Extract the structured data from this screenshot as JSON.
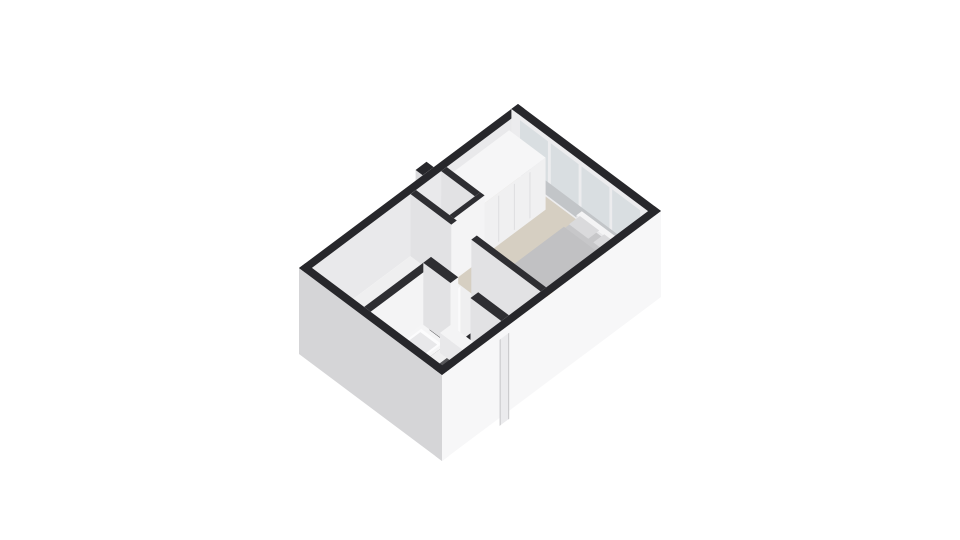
{
  "canvas": {
    "width": 960,
    "height": 540,
    "background": "#ffffff"
  },
  "scene": {
    "description": "3D isometric floor plan render of an upper floor with bedroom, hallway, staircase and bathroom",
    "rooms": [
      "bedroom",
      "closet-nook",
      "hallway",
      "staircase",
      "bathroom",
      "open-room"
    ],
    "palette": {
      "wall_top_exterior": "#27272b",
      "wall_top_interior": "#2e2e32",
      "facade_sw": "#d5d5d7",
      "facade_se": "#f7f7f8",
      "facade_seam": "#c9c9cb",
      "inner_wall_light": "#f4f4f5",
      "inner_wall_shade": "#e2e2e4",
      "floor_hall": "#efeff0",
      "floor_carpet": "#d6cfc2",
      "floor_bathroom": "#57575a",
      "glass": "#d9dee1",
      "stair_tread": "#2b2b2f",
      "lamp_amber": "#d9993e"
    }
  },
  "projection": {
    "origin": [
      299,
      268
    ],
    "axis_x": [
      219,
      -164
    ],
    "axis_y": [
      143,
      107
    ],
    "wall_top_z": 62
  },
  "elements": [
    {
      "name": "exterior-duct-bump",
      "type": "box",
      "rect": [
        0.565,
        -0.05,
        0.615,
        0.0
      ],
      "z0": 0,
      "z1": 62,
      "top": "#27272b",
      "sw": "#dcdcde",
      "se": "#e9e9eb"
    },
    {
      "name": "wall-northwest-exterior",
      "type": "box",
      "rect": [
        0,
        0,
        1,
        0.045
      ],
      "z0": 0,
      "z1": 62,
      "top": "#27272b",
      "sw": "#d6d6d8",
      "se": "#e9e9eb"
    },
    {
      "name": "wall-northeast-exterior",
      "type": "box",
      "rect": [
        0.97,
        0,
        1,
        1
      ],
      "z0": 0,
      "z1": 62,
      "top": "#27272b",
      "sw": "#ececee",
      "se": "#f7f7f8"
    },
    {
      "name": "window-pane-1",
      "type": "face",
      "plane": "x",
      "at": 0.97,
      "range": [
        0.06,
        0.255
      ],
      "z": [
        5,
        57
      ],
      "fill": "#d9dee1"
    },
    {
      "name": "window-pane-2",
      "type": "face",
      "plane": "x",
      "at": 0.97,
      "range": [
        0.275,
        0.47
      ],
      "z": [
        5,
        57
      ],
      "fill": "#d9dee1"
    },
    {
      "name": "window-pane-3",
      "type": "face",
      "plane": "x",
      "at": 0.97,
      "range": [
        0.49,
        0.685
      ],
      "z": [
        5,
        57
      ],
      "fill": "#d9dee1"
    },
    {
      "name": "window-pane-4",
      "type": "face",
      "plane": "x",
      "at": 0.97,
      "range": [
        0.705,
        0.9
      ],
      "z": [
        5,
        57
      ],
      "fill": "#d9dee1"
    },
    {
      "name": "window-sill-band",
      "type": "face",
      "plane": "x",
      "at": 0.97,
      "range": [
        0.06,
        0.9
      ],
      "z": [
        2,
        16
      ],
      "fill": "#c2c5c8"
    },
    {
      "name": "floor-hallway-base",
      "type": "floor",
      "rect": [
        0.03,
        0.045,
        0.97,
        0.955
      ],
      "z": 0,
      "fill": "#efeff0"
    },
    {
      "name": "floor-bedroom-carpet",
      "type": "floor",
      "rect": [
        0.505,
        0.045,
        0.97,
        0.955
      ],
      "z": 0,
      "fill": "#d6cfc2"
    },
    {
      "name": "floor-closet-nook",
      "type": "floor",
      "rect": [
        0.505,
        0.045,
        0.62,
        0.28
      ],
      "z": 0,
      "fill": "#e4e4e6"
    },
    {
      "name": "floor-bathroom-tile",
      "type": "floor",
      "rect": [
        0.03,
        0.455,
        0.3,
        0.955
      ],
      "z": 0,
      "fill": "#57575a",
      "speckle": {
        "count": 170,
        "colors": [
          "#6e6e71",
          "#3b3b3e",
          "#7d7d80"
        ]
      }
    },
    {
      "name": "nook-cabinet",
      "type": "box",
      "rect": [
        0.515,
        0.06,
        0.6,
        0.26
      ],
      "z0": 0,
      "z1": 30,
      "top": "#f7f7f8",
      "sw": "#eaeaec",
      "se": "#f2f2f3"
    },
    {
      "name": "wardrobe",
      "type": "box",
      "rect": [
        0.645,
        0.045,
        0.93,
        0.3
      ],
      "z0": 0,
      "z1": 52,
      "top": "#f6f6f7",
      "sw": "#e8e8ea",
      "se": "#f0f0f1",
      "seams": [
        0.25,
        0.5,
        0.75
      ],
      "seam_color": "#dcdcde"
    },
    {
      "name": "window-ledge",
      "type": "box",
      "rect": [
        0.94,
        0.5,
        0.965,
        0.87
      ],
      "z0": 0,
      "z1": 14,
      "top": "#f4f4f5",
      "sw": "#e9e9eb",
      "se": "#efeff1"
    },
    {
      "name": "bed-base",
      "type": "box",
      "rect": [
        0.63,
        0.5,
        0.945,
        0.875
      ],
      "z0": 0,
      "z1": 10,
      "top": "#c7c7c9",
      "sw": "#b5b5b7",
      "se": "#c0c0c2"
    },
    {
      "name": "bed-duvet",
      "type": "floor",
      "rect": [
        0.635,
        0.505,
        0.88,
        0.87
      ],
      "z": 13,
      "round": 10,
      "fill": "#c1c1c3"
    },
    {
      "name": "bed-pillow-1",
      "type": "floor",
      "rect": [
        0.89,
        0.525,
        0.94,
        0.66
      ],
      "z": 16,
      "round": 9,
      "fill": "#dadadc"
    },
    {
      "name": "bed-pillow-2",
      "type": "floor",
      "rect": [
        0.89,
        0.695,
        0.94,
        0.85
      ],
      "z": 16,
      "round": 9,
      "fill": "#dadadc"
    },
    {
      "name": "bed-foot-bench",
      "type": "box",
      "rect": [
        0.602,
        0.535,
        0.628,
        0.835
      ],
      "z0": 0,
      "z1": 9,
      "top": "#f1f1f2",
      "sw": "#e4e4e6",
      "se": "#ededef"
    },
    {
      "name": "nightstand",
      "type": "box",
      "rect": [
        0.575,
        0.79,
        0.635,
        0.88
      ],
      "z0": 0,
      "z1": 16,
      "top": "#f5f5f6",
      "sw": "#e9e9eb",
      "se": "#efeff1"
    },
    {
      "name": "bedside-lamp",
      "type": "box",
      "rect": [
        0.592,
        0.806,
        0.614,
        0.842
      ],
      "z0": 16,
      "z1": 27,
      "top": "#e2a94f",
      "sw": "#cf923a",
      "se": "#d9993e"
    },
    {
      "name": "lamp-knob",
      "type": "dot",
      "x": 0.62,
      "y": 0.858,
      "z": 16,
      "r": 2.6,
      "fill": "#f6f6f6"
    },
    {
      "name": "wall-nook-east",
      "type": "box",
      "rect": [
        0.62,
        0.045,
        0.645,
        0.28
      ],
      "z0": 0,
      "z1": 62,
      "top": "#2e2e32",
      "sw": "#e2e2e4",
      "se": "#f4f4f5"
    },
    {
      "name": "wall-nook-south",
      "type": "box",
      "rect": [
        0.505,
        0.28,
        0.645,
        0.31
      ],
      "z0": 0,
      "z1": 62,
      "top": "#2e2e32",
      "sw": "#e2e2e4",
      "se": "#f4f4f5"
    },
    {
      "name": "wall-bedroom-a",
      "type": "box",
      "rect": [
        0.48,
        0.045,
        0.505,
        0.33
      ],
      "z0": 0,
      "z1": 62,
      "top": "#2e2e32",
      "sw": "#e2e2e4",
      "se": "#f4f4f5"
    },
    {
      "name": "wall-bedroom-b",
      "type": "box",
      "rect": [
        0.48,
        0.47,
        0.505,
        0.955
      ],
      "z0": 0,
      "z1": 62,
      "top": "#2e2e32",
      "sw": "#e2e2e4",
      "se": "#f4f4f5"
    },
    {
      "name": "staircase",
      "type": "stairs",
      "x": [
        0.35,
        0.465
      ],
      "y0": 0.6,
      "steps": 7,
      "dy": 0.05,
      "dz": 3.3,
      "tread": "#2b2b2f",
      "riser": "#eeeeef"
    },
    {
      "name": "bathroom-door-leaf",
      "type": "box",
      "rect": [
        0.34,
        0.44,
        0.355,
        0.585
      ],
      "z0": 0,
      "z1": 48,
      "top": "#f3f3f4",
      "sw": "#e7e7e9",
      "se": "#fafafb"
    },
    {
      "name": "wall-bathroom-north",
      "type": "box",
      "rect": [
        0.03,
        0.41,
        0.3,
        0.455
      ],
      "z0": 0,
      "z1": 62,
      "top": "#2e2e32",
      "sw": "#e2e2e4",
      "se": "#f4f4f5"
    },
    {
      "name": "wall-bathroom-east-a",
      "type": "box",
      "rect": [
        0.3,
        0.41,
        0.335,
        0.6
      ],
      "z0": 0,
      "z1": 62,
      "top": "#2e2e32",
      "sw": "#e2e2e4",
      "se": "#f4f4f5"
    },
    {
      "name": "wall-bathroom-east-b",
      "type": "box",
      "rect": [
        0.3,
        0.74,
        0.335,
        0.955
      ],
      "z0": 0,
      "z1": 62,
      "top": "#2e2e32",
      "sw": "#e2e2e4",
      "se": "#f4f4f5"
    },
    {
      "name": "bathtub",
      "type": "box",
      "rect": [
        0.045,
        0.468,
        0.255,
        0.648
      ],
      "z0": 0,
      "z1": 14,
      "top": "#f5f5f6",
      "sw": "#e9e9ea",
      "se": "#efeff0"
    },
    {
      "name": "bathtub-inner",
      "type": "floor",
      "rect": [
        0.062,
        0.487,
        0.24,
        0.63
      ],
      "z": 14,
      "round": 9,
      "fill": "#fcfcfd"
    },
    {
      "name": "bathtub-basin",
      "type": "floor",
      "rect": [
        0.075,
        0.5,
        0.228,
        0.617
      ],
      "z": 14,
      "round": 9,
      "fill": "#e8e8ea"
    },
    {
      "name": "bathtub-faucet",
      "type": "dot",
      "x": 0.075,
      "y": 0.495,
      "z": 19,
      "r": 2.4,
      "fill": "#ffffff"
    },
    {
      "name": "vanity-unit",
      "type": "box",
      "rect": [
        0.252,
        0.6,
        0.3,
        0.76
      ],
      "z0": 0,
      "z1": 20,
      "top": "#f4f4f5",
      "sw": "#e8e8ea",
      "se": "#eeeef0"
    },
    {
      "name": "toilet",
      "type": "box",
      "rect": [
        0.252,
        0.8,
        0.3,
        0.9
      ],
      "z0": 0,
      "z1": 13,
      "top": "#f6f6f7",
      "sw": "#eaeaec",
      "se": "#f0f0f2"
    },
    {
      "name": "toilet-lid",
      "type": "dot",
      "x": 0.272,
      "y": 0.85,
      "z": 13,
      "r": 3.4,
      "fill": "#e9e9eb"
    },
    {
      "name": "bathroom-radiator",
      "type": "box",
      "rect": [
        0.19,
        0.925,
        0.24,
        0.955
      ],
      "z0": 0,
      "z1": 26,
      "top": "#f4f4f5",
      "sw": "#e8e8ea",
      "se": "#eeeef0"
    },
    {
      "name": "wall-southwest-exterior",
      "type": "box",
      "rect": [
        0,
        0,
        0.03,
        1
      ],
      "z0": -24,
      "z1": 62,
      "top": "#27272b",
      "sw": "#d5d5d7",
      "se": "#f0f0f2"
    },
    {
      "name": "wall-southeast-exterior",
      "type": "box",
      "rect": [
        0,
        0.955,
        1,
        1
      ],
      "z0": -24,
      "z1": 62,
      "top": "#27272b",
      "sw": "#d5d5d7",
      "se": "#f7f7f8"
    },
    {
      "name": "facade-stair-bay",
      "type": "face",
      "plane": "y",
      "at": 1,
      "range": [
        0.265,
        0.305
      ],
      "z": [
        -32,
        54
      ],
      "fill": "#ebebed"
    },
    {
      "name": "facade-seam-left",
      "type": "face",
      "plane": "y",
      "at": 1,
      "range": [
        0.263,
        0.268
      ],
      "z": [
        -32,
        54
      ],
      "fill": "#c9c9cb"
    },
    {
      "name": "facade-seam-right",
      "type": "face",
      "plane": "y",
      "at": 1,
      "range": [
        0.302,
        0.307
      ],
      "z": [
        -32,
        54
      ],
      "fill": "#c9c9cb"
    }
  ]
}
